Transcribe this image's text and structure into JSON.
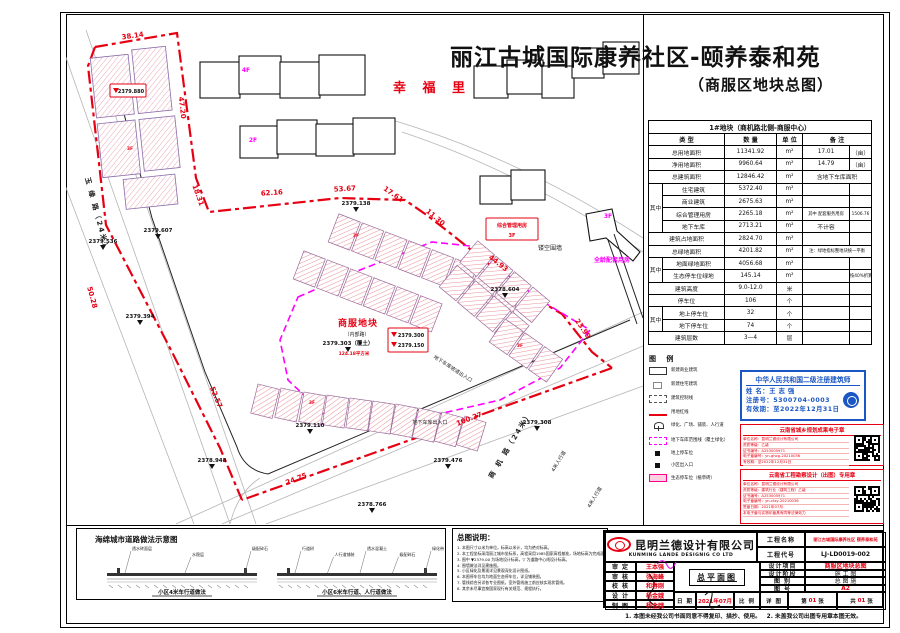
{
  "page": {
    "title": "丽江古城国际康养社区-颐养泰和苑",
    "subtitle": "（商服区地块总图）"
  },
  "colors": {
    "red": "#e60012",
    "magenta": "#ff00ff",
    "stamp_blue": "#1a56c4"
  },
  "plan": {
    "dims": [
      {
        "t": "38.14",
        "x": 133,
        "y": 38,
        "r": -8
      },
      {
        "t": "47.20",
        "x": 180,
        "y": 108,
        "r": 83
      },
      {
        "t": "18.31",
        "x": 196,
        "y": 196,
        "r": 70
      },
      {
        "t": "50.28",
        "x": 90,
        "y": 298,
        "r": 75
      },
      {
        "t": "62.16",
        "x": 272,
        "y": 195,
        "r": -4
      },
      {
        "t": "53.67",
        "x": 345,
        "y": 191,
        "r": -3
      },
      {
        "t": "17.61",
        "x": 392,
        "y": 196,
        "r": 35
      },
      {
        "t": "11.30",
        "x": 434,
        "y": 219,
        "r": 40
      },
      {
        "t": "44.93",
        "x": 497,
        "y": 265,
        "r": 38
      },
      {
        "t": "23.99",
        "x": 581,
        "y": 330,
        "r": 55
      },
      {
        "t": "100.27",
        "x": 470,
        "y": 421,
        "r": -21
      },
      {
        "t": "24.75",
        "x": 297,
        "y": 481,
        "r": -21
      },
      {
        "t": "52.57",
        "x": 214,
        "y": 398,
        "r": 68
      }
    ],
    "elevs": [
      {
        "t": "2379.536",
        "x": 103,
        "y": 243
      },
      {
        "t": "2379.607",
        "x": 158,
        "y": 232
      },
      {
        "t": "2379.394",
        "x": 140,
        "y": 318
      },
      {
        "t": "2379.138",
        "x": 356,
        "y": 205
      },
      {
        "t": "2378.604",
        "x": 505,
        "y": 291
      },
      {
        "t": "2379.303（覆土）",
        "x": 348,
        "y": 345
      },
      {
        "t": "2379.110",
        "x": 310,
        "y": 427
      },
      {
        "t": "2378.948",
        "x": 212,
        "y": 462
      },
      {
        "t": "2379.476",
        "x": 448,
        "y": 462
      },
      {
        "t": "2379.308",
        "x": 537,
        "y": 424
      },
      {
        "t": "2378.766",
        "x": 372,
        "y": 506
      }
    ],
    "labels": [
      {
        "t": "幸 福 里",
        "x": 432,
        "y": 92,
        "cls": "red-xl"
      },
      {
        "t": "商服地块",
        "x": 358,
        "y": 326,
        "cls": "red-big"
      },
      {
        "t": "（内部路）",
        "x": 357,
        "y": 336,
        "cls": "blk-xs"
      },
      {
        "t": "124.18平方米",
        "x": 354,
        "y": 355,
        "cls": "red-xs"
      },
      {
        "t": "镂空围墙",
        "x": 550,
        "y": 250,
        "cls": "blk-sm"
      },
      {
        "t": "全龄配套用房",
        "x": 612,
        "y": 262,
        "cls": "mag-sm"
      },
      {
        "t": "3F",
        "x": 608,
        "y": 218,
        "cls": "mag-sm"
      },
      {
        "t": "4F",
        "x": 246,
        "y": 72,
        "cls": "mag-sm"
      },
      {
        "t": "2F",
        "x": 253,
        "y": 142,
        "cls": "mag-sm"
      },
      {
        "t": "3F",
        "x": 118,
        "y": 88,
        "cls": "red-xs"
      },
      {
        "t": "3F",
        "x": 130,
        "y": 150,
        "cls": "red-xs"
      },
      {
        "t": "3F",
        "x": 356,
        "y": 237,
        "cls": "red-xs"
      },
      {
        "t": "3F",
        "x": 312,
        "y": 404,
        "cls": "red-xs"
      },
      {
        "t": "3F",
        "x": 520,
        "y": 347,
        "cls": "red-xs"
      },
      {
        "t": "地下车库坡道出入口",
        "x": 452,
        "y": 370,
        "cls": "blk-xs",
        "r": 33
      },
      {
        "t": "地下车库出入口",
        "x": 430,
        "y": 424,
        "cls": "blk-xs"
      },
      {
        "t": "商 机 路（24米）",
        "x": 512,
        "y": 446,
        "cls": "blk-road",
        "r": -59
      },
      {
        "t": "玉 缘 路（24米）",
        "x": 95,
        "y": 215,
        "cls": "blk-road",
        "r": 75
      },
      {
        "t": "4米人行道",
        "x": 560,
        "y": 462,
        "cls": "blk-xs",
        "r": -59
      },
      {
        "t": "4米人行道",
        "x": 596,
        "y": 498,
        "cls": "blk-xs",
        "r": -59
      }
    ],
    "boxes": [
      {
        "x": 110,
        "y": 84,
        "w": 36,
        "h": 13,
        "lines": [
          "2379.880"
        ],
        "tri": true
      },
      {
        "x": 388,
        "y": 328,
        "w": 40,
        "h": 24,
        "lines": [
          "2379.300",
          "2379.150"
        ],
        "tri": true
      },
      {
        "x": 486,
        "y": 218,
        "w": 52,
        "h": 22,
        "lines": [
          "综合管理用房",
          "3F"
        ],
        "tri": false
      }
    ]
  },
  "table": {
    "title": "1#地块（商机路北侧-商服中心）",
    "col_type": "类  型",
    "col_qty": "数  量",
    "col_unit": "单  位",
    "col_note": "备  注",
    "group_label": "其中",
    "rows": [
      {
        "g": "",
        "label": "总用地面积",
        "qty": "11341.92",
        "unit": "m²",
        "n1": "17.01",
        "n2": "（亩）"
      },
      {
        "g": "",
        "label": "净用地面积",
        "qty": "9960.64",
        "unit": "m²",
        "n1": "14.79",
        "n2": "（亩）"
      },
      {
        "g": "",
        "label": "总建筑面积",
        "qty": "12846.42",
        "unit": "m²",
        "n1": "含地下车库面积",
        "n2": "",
        "span": true
      },
      {
        "g": "其中",
        "label": "住宅建筑",
        "qty": "5372.40",
        "unit": "m²",
        "n1": "",
        "n2": ""
      },
      {
        "g": "其中",
        "label": "商业建筑",
        "qty": "2675.63",
        "unit": "m²",
        "n1": "",
        "n2": ""
      },
      {
        "g": "其中",
        "label": "综合管理用房",
        "qty": "2265.18",
        "unit": "m²",
        "n1": "其中 配套服务用房",
        "n2": "1506.76"
      },
      {
        "g": "其中",
        "label": "地下车库",
        "qty": "2713.21",
        "unit": "m²",
        "n1": "不计容",
        "n2": ""
      },
      {
        "g": "",
        "label": "建筑占地面积",
        "qty": "2824.70",
        "unit": "m²",
        "n1": "",
        "n2": ""
      },
      {
        "g": "",
        "label": "总绿地面积",
        "qty": "4201.82",
        "unit": "m²",
        "n1": "注：绿地指标整地块统一平衡",
        "n2": "",
        "span": true
      },
      {
        "g": "其中",
        "label": "地面绿地面积",
        "qty": "4056.68",
        "unit": "m²",
        "n1": "",
        "n2": ""
      },
      {
        "g": "其中",
        "label": "生态停车位绿地",
        "qty": "145.14",
        "unit": "m²",
        "n1": "",
        "n2": "按40%折算"
      },
      {
        "g": "",
        "label": "建筑高度",
        "qty": "9.0-12.0",
        "unit": "米",
        "n1": "",
        "n2": ""
      },
      {
        "g": "",
        "label": "停车位",
        "qty": "106",
        "unit": "个",
        "n1": "",
        "n2": ""
      },
      {
        "g": "其中",
        "label": "地上停车位",
        "qty": "32",
        "unit": "个",
        "n1": "",
        "n2": ""
      },
      {
        "g": "其中",
        "label": "地下停车位",
        "qty": "74",
        "unit": "个",
        "n1": "",
        "n2": ""
      },
      {
        "g": "",
        "label": "建筑层数",
        "qty": "3—4",
        "unit": "层",
        "n1": "",
        "n2": ""
      }
    ]
  },
  "legend": {
    "title": "图  例",
    "items": [
      {
        "sym": "rect-outline",
        "label": "新建商业建筑"
      },
      {
        "sym": "rect-small",
        "label": "新建住宅建筑"
      },
      {
        "sym": "rect-dash",
        "label": "建筑控制线"
      },
      {
        "sym": "red-line",
        "label": "用地红线"
      },
      {
        "sym": "tree",
        "label": "绿化、广场、铺装、人行道"
      },
      {
        "sym": "pink-dash",
        "label": "地下车库范围线（覆土绿化）"
      },
      {
        "sym": "sq-black",
        "label": "地上停车位"
      },
      {
        "sym": "sq-dark",
        "label": "小区出入口"
      },
      {
        "sym": "pink-rect",
        "label": "生态停车位（植草砖）"
      }
    ]
  },
  "stamp": {
    "title": "中华人民共和国二级注册建筑师",
    "name": "姓  名：王 志 强",
    "reg": "注册号：5300704-0003",
    "valid": "有效期：至2022年12月31日"
  },
  "seals": [
    {
      "title": "云南省城乡规划成果电子章",
      "lines": [
        "单位名称：昆明兰德设计有限公司",
        "资质等级：乙级",
        "证书编号：A253005971",
        "电子章编号：yn-ghcg-20210036",
        "有效期：至2022年12月31日"
      ]
    },
    {
      "title": "云南省工程勘察设计（出图）专用章",
      "lines": [
        "单位名称：昆明兰德设计有限公司",
        "资质等级：建筑行业（建筑工程）乙级",
        "证书编号：A253005971",
        "电子章编号：yn-ctzy-20210036",
        "签章日期：2021年07月",
        "本电子章与实物印章具有同等法律效力"
      ]
    }
  ],
  "notes": {
    "title": "总图说明：",
    "items": [
      "本图尺寸以米为单位，标高以米计，均为绝对标高。",
      "本工程坐标采用丽江城市坐标系，高程采用1985国家高程基准，场地标高为完成面标高（覆土）。",
      "图中 ▼2379.00 为场地设计标高，▽ 为道路中心线设计标高。",
      "围墙做法详见建施图。",
      "小区绿化及景观详见景观深化设计图纸。",
      "本图停车位均为地面生态停车位，详见铺装图。",
      "管线综合另详各专业图纸，室外管线施工前应核实现状管线。",
      "其余未尽事宜按国家现行有关规范、规程执行。"
    ]
  },
  "sponge": {
    "title": "海绵城市道路做法示意图",
    "caption1": "小区4米车行道做法",
    "caption2": "小区6米车行道、人行道做法",
    "l1": [
      "透水砖面层",
      "水稳层",
      "级配碎石"
    ],
    "l2": [
      "行道树",
      "人行道铺装",
      "透水混凝土",
      "级配碎石",
      "绿化带"
    ]
  },
  "titleblock": {
    "company": "昆明兰德设计有限公司",
    "company_en": "KUNMING LANDE DESIGNIG CO LTD",
    "f_name": "工程名称",
    "v_name": "丽江古城国际康养社区 颐养泰和苑",
    "f_code": "工程代号",
    "v_code": "LJ-LD0019-002",
    "signs": [
      {
        "label": "审  定",
        "name": "王本强"
      },
      {
        "label": "审  核",
        "name": "张海峰"
      },
      {
        "label": "校  核",
        "name": "和春刚"
      },
      {
        "label": "设  计",
        "name": "杨金娥"
      },
      {
        "label": "制  图",
        "name": "杨金娥"
      }
    ],
    "drawing": "总平面图",
    "date_label": "日  期",
    "date": "2021年07月",
    "scale_label": "比  例",
    "rights": [
      {
        "label": "设计项目",
        "value": "商服区地块总图",
        "red": true
      },
      {
        "label": "设计阶段",
        "value": "施 工 图"
      },
      {
        "label": "图  别",
        "value": "总 图 施"
      },
      {
        "label": "图  号",
        "value": "A2",
        "red": true
      }
    ],
    "detail_label": "详  图",
    "sheet_pre": "第",
    "sheet_no": "01",
    "sheet_suf": "张",
    "total_pre": "共",
    "total_no": "01",
    "total_suf": "张",
    "footnote": "1. 本图未经我公司书面同意不得复印、描抄、使用。　2. 未盖我公司出图专用章本图无效。"
  }
}
